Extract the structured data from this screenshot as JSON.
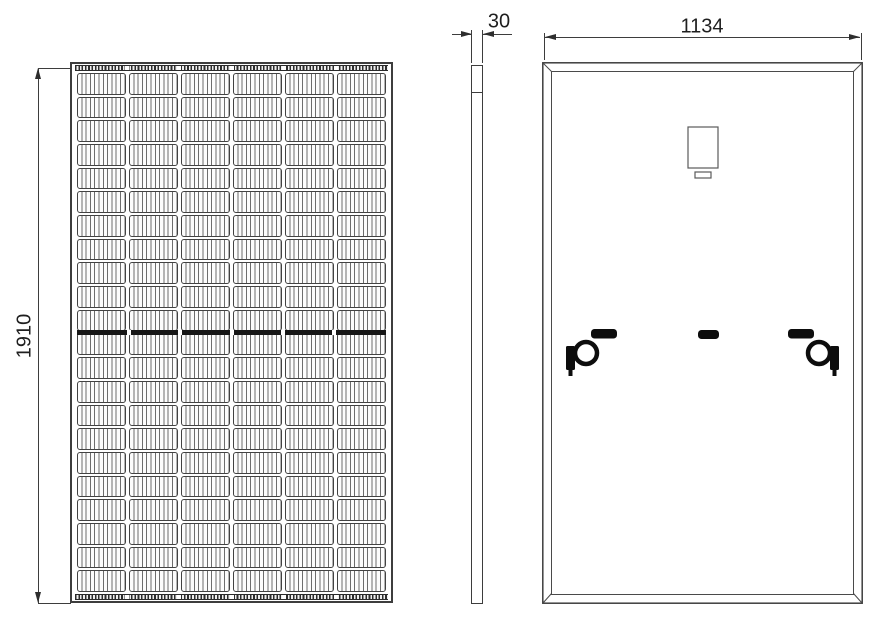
{
  "drawing": {
    "type": "solar-panel-technical-drawing",
    "colors": {
      "line": "#3d3d3d",
      "dark_fill": "#0d0d0d",
      "background": "#ffffff"
    }
  },
  "front_view": {
    "height_dimension": "1910",
    "cell_columns": 6,
    "cell_rows": 22
  },
  "side_view": {
    "thickness_dimension": "30"
  },
  "back_view": {
    "width_dimension": "1134"
  }
}
